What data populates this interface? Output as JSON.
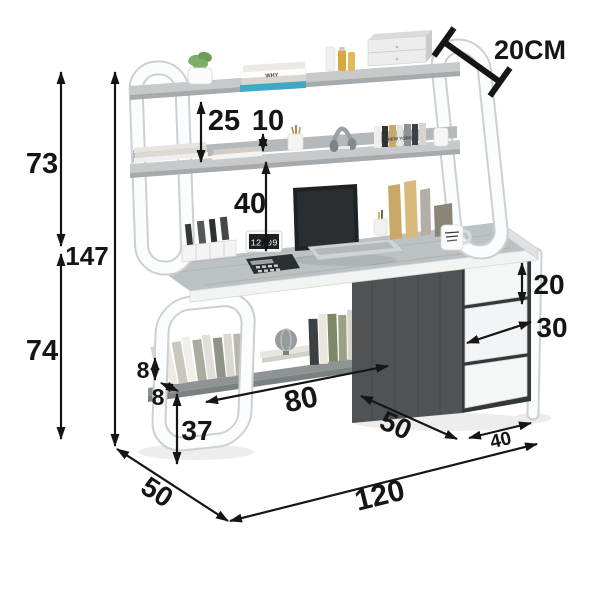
{
  "page": {
    "background": "#ffffff",
    "description": "Product dimension diagram: white-frame computer desk with hutch bookshelf, under-desk shelf and three-drawer cabinet, annotated with centimeter measurements"
  },
  "dims": {
    "hutch_height": "73",
    "total_height": "147",
    "desk_height": "74",
    "shelf_spacing": "25",
    "shelf_rail_height": "10",
    "hutch_clearance": "40",
    "top_shelf_depth": "20CM",
    "top_drawer_height": "20",
    "drawer_width": "30",
    "book_stop_height": "8",
    "shelf_board_thickness": "8",
    "under_shelf_length": "80",
    "under_shelf_clearance": "37",
    "desk_side_depth": "50",
    "cabinet_side_depth": "50",
    "cabinet_width": "40",
    "desk_length": "120"
  },
  "scene": {
    "clock_display": "12:09",
    "book_spine_text": "WHY",
    "books_row_text": "NEW YORK",
    "items": [
      "potted plant",
      "stacked books",
      "storage bottles",
      "mini drawer organizer",
      "document stack",
      "pencil cup",
      "headphones",
      "standing books",
      "small vase",
      "desktop card organizer",
      "digital clock",
      "calculator",
      "laptop",
      "pen cup",
      "wooden file holders",
      "coffee mug",
      "leaning books",
      "globe ornament",
      "shelf books"
    ]
  },
  "colors": {
    "frame_white": "#fbfcfd",
    "frame_edge": "#ccd0d2",
    "shelf_board": "#c6cacb",
    "desktop_gray": "#bcc1c3",
    "cabinet_dark": "#4f5355",
    "drawer_white": "#f5f6f6",
    "annotation_black": "#151515",
    "accent_teal": "#3fa8c4",
    "accent_wood": "#cfa869",
    "plant_green": "#7fae68"
  }
}
